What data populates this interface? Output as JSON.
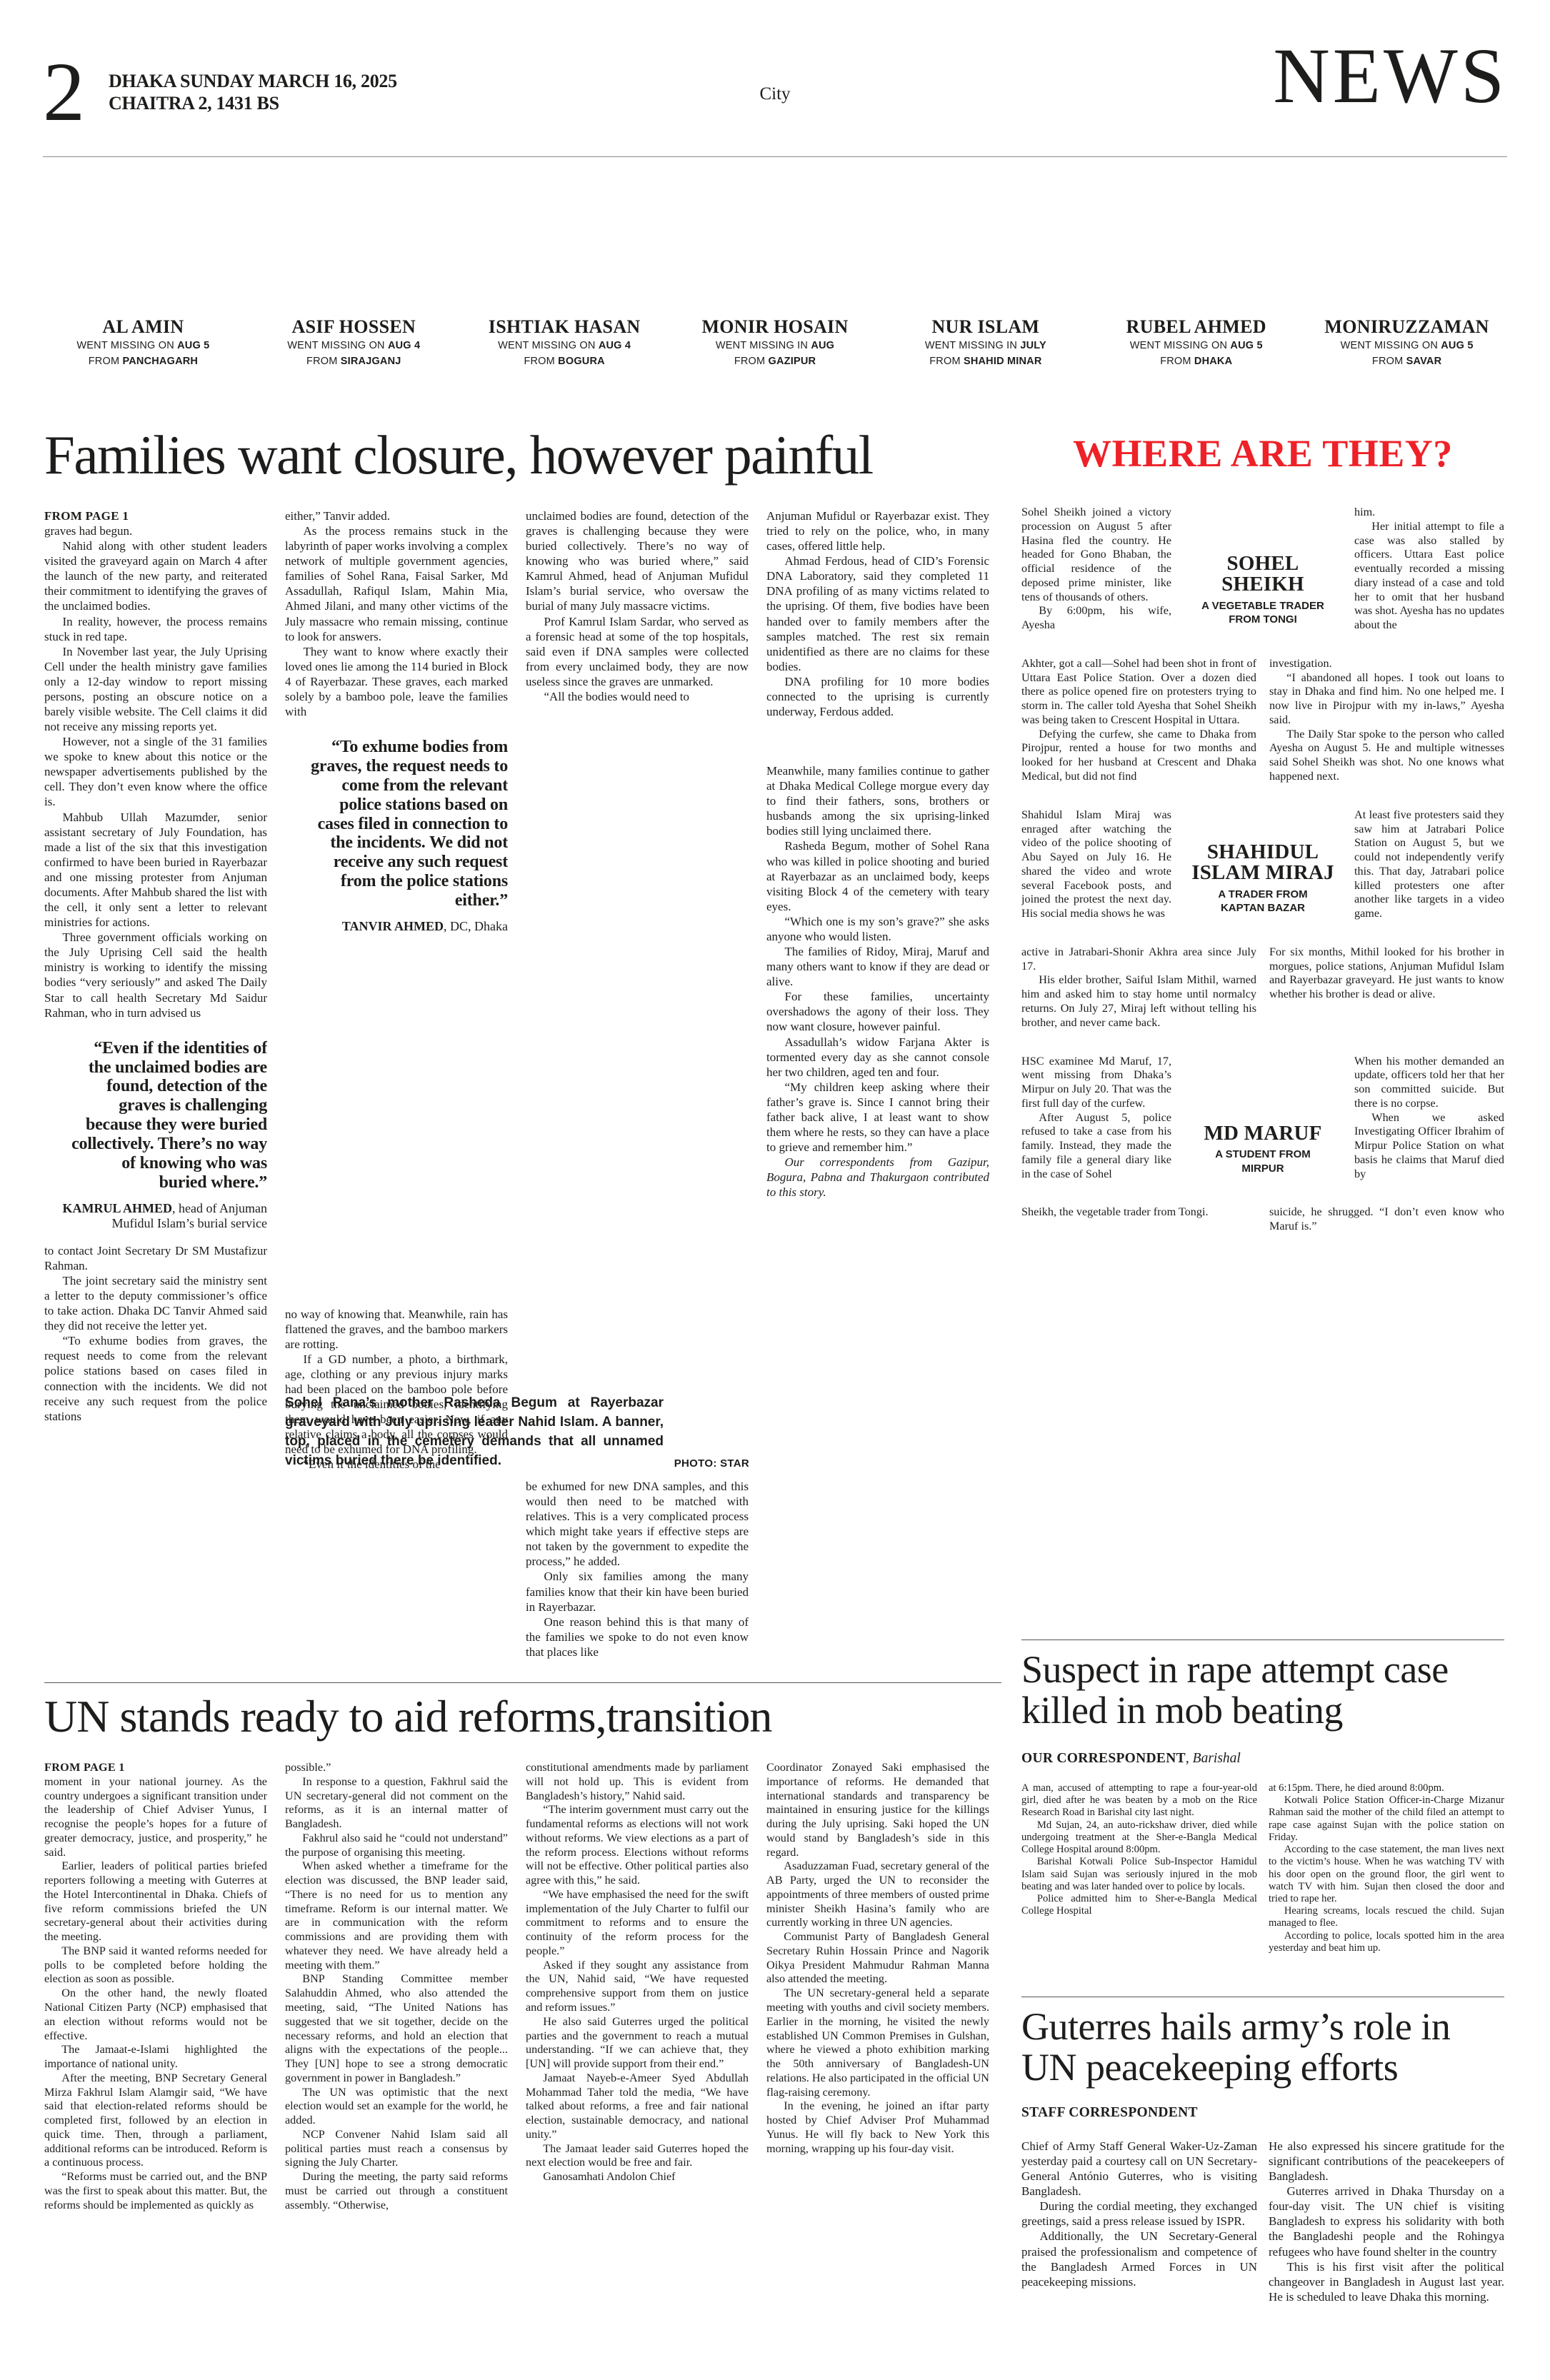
{
  "header": {
    "page_number": "2",
    "date": "DHAKA SUNDAY MARCH 16, 2025",
    "calendar": "CHAITRA 2, 1431 BS",
    "section": "City",
    "masthead": "NEWS"
  },
  "missing_strip": [
    {
      "name": "AL AMIN",
      "missing_prefix": "WENT MISSING ON ",
      "missing_date": "AUG 5",
      "from_prefix": "FROM ",
      "from_place": "PANCHAGARH"
    },
    {
      "name": "ASIF HOSSEN",
      "missing_prefix": "WENT MISSING ON ",
      "missing_date": "AUG 4",
      "from_prefix": "FROM ",
      "from_place": "SIRAJGANJ"
    },
    {
      "name": "ISHTIAK HASAN",
      "missing_prefix": "WENT MISSING ON ",
      "missing_date": "AUG 4",
      "from_prefix": "FROM ",
      "from_place": "BOGURA"
    },
    {
      "name": "MONIR HOSAIN",
      "missing_prefix": "WENT MISSING IN ",
      "missing_date": "AUG",
      "from_prefix": "FROM ",
      "from_place": "GAZIPUR"
    },
    {
      "name": "NUR ISLAM",
      "missing_prefix": "WENT MISSING IN ",
      "missing_date": "JULY",
      "from_prefix": "FROM ",
      "from_place": "SHAHID MINAR"
    },
    {
      "name": "RUBEL AHMED",
      "missing_prefix": "WENT MISSING ON ",
      "missing_date": "AUG 5",
      "from_prefix": "FROM ",
      "from_place": "DHAKA"
    },
    {
      "name": "MONIRUZZAMAN",
      "missing_prefix": "WENT MISSING ON ",
      "missing_date": "AUG 5",
      "from_prefix": "FROM ",
      "from_place": "SAVAR"
    }
  ],
  "families_article": {
    "headline": "Families want closure, however painful",
    "kicker": "FROM PAGE 1",
    "col1a": [
      "graves had begun.",
      "Nahid along with other student leaders visited the graveyard again on March 4 after the launch of the new party, and reiterated their commitment to identifying the graves of the unclaimed bodies.",
      "In reality, however, the process remains stuck in red tape.",
      "In November last year, the July Uprising Cell under the health ministry gave families only a 12-day window to report missing persons, posting an obscure notice on a barely visible website. The Cell claims it did not receive any missing reports yet.",
      "However, not a single of the 31 families we spoke to knew about this notice or the newspaper advertisements published by the cell. They don’t even know where the office is.",
      "Mahbub Ullah Mazumder, senior assistant secretary of July Foundation, has made a list of the six that this investigation confirmed to have been buried in Rayerbazar and one missing protester from Anjuman documents. After Mahbub shared the list with the cell, it only sent a letter to relevant ministries for actions.",
      "Three government officials working on the July Uprising Cell said the health ministry is working to identify the missing bodies “very seriously” and asked The Daily Star to call health Secretary Md Saidur Rahman, who in turn advised us"
    ],
    "pullquote1": {
      "text": "“Even if the identities of the unclaimed bodies are found, detection of the graves is challenging because they were buried collectively. There’s no way of knowing who was buried where.”",
      "name": "KAMRUL AHMED",
      "desc": ", head of Anjuman Mufidul Islam’s burial service"
    },
    "col1b": [
      "to contact Joint Secretary Dr SM Mustafizur Rahman.",
      "The joint secretary said the ministry sent a letter to the deputy commissioner’s office to take action. Dhaka DC Tanvir Ahmed said they did not receive the letter yet.",
      "“To exhume bodies from graves, the request needs to come from the relevant police stations based on cases filed in connection with the incidents. We did not receive any such request from the police stations"
    ],
    "col2a": [
      "either,” Tanvir added.",
      "As the process remains stuck in the labyrinth of paper works involving a complex network of multiple government agencies, families of Sohel Rana, Faisal Sarker, Md Assadullah, Rafiqul Islam, Mahin Mia, Ahmed Jilani, and many other victims of the July massacre who remain missing, continue to look for answers.",
      "They want to know where exactly their loved ones lie among the 114 buried in Block 4 of Rayerbazar. These graves, each marked solely by a bamboo pole, leave the families with"
    ],
    "pullquote2": {
      "text": "“To exhume bodies from graves, the request needs to come from the relevant police stations based on cases filed in connection to the incidents. We did not receive any such request from the police stations either.”",
      "name": "TANVIR AHMED",
      "desc": ", DC, Dhaka"
    },
    "col2b": [
      "no way of knowing that. Meanwhile, rain has flattened the graves, and the bamboo markers are rotting.",
      "If a GD number, a photo, a birthmark, age, clothing or any previous injury marks had been placed on the bamboo pole before burying the unclaimed bodies, identifying them would have been easier. Now, if any relative claims a body, all the corpses would need to be exhumed for DNA profiling.",
      "“Even if the identities of the"
    ],
    "col3a": [
      "unclaimed bodies are found, detection of the graves is challenging because they were buried collectively. There’s no way of knowing who was buried where,” said Kamrul Ahmed, head of Anjuman Mufidul Islam’s burial service, who oversaw the burial of many July massacre victims.",
      "Prof Kamrul Islam Sardar, who served as a forensic head at some of the top hospitals, said even if DNA samples were collected from every unclaimed body, they are now useless since the graves are unmarked.",
      "“All the bodies would need to"
    ],
    "col3b": [
      "be exhumed for new DNA samples, and this would then need to be matched with relatives. This is a very complicated process which might take years if effective steps are not taken by the government to expedite the process,” he added.",
      "Only six families among the many families know that their kin have been buried in Rayerbazar.",
      "One reason behind this is that many of the families we spoke to do not even know that places like"
    ],
    "col4a": [
      "Anjuman Mufidul or Rayerbazar exist. They tried to rely on the police, who, in many cases, offered little help.",
      "Ahmad Ferdous, head of CID’s Forensic DNA Laboratory, said they completed 11 DNA profiling of as many victims related to the uprising. Of them, five bodies have been handed over to family members after the samples matched. The rest six remain unidentified as there are no claims for these bodies.",
      "DNA profiling for 10 more bodies connected to the uprising is currently underway, Ferdous added."
    ],
    "col4b": [
      "Meanwhile, many families continue to gather at Dhaka Medical College morgue every day to find their fathers, sons, brothers or husbands among the six uprising-linked bodies still lying unclaimed there.",
      "Rasheda Begum, mother of Sohel Rana who was killed in police shooting and buried at Rayerbazar as an unclaimed body, keeps visiting Block 4 of the cemetery with teary eyes.",
      "“Which one is my son’s grave?” she asks anyone who would listen.",
      "The families of Ridoy, Miraj, Maruf and many others want to know if they are dead or alive.",
      "For these families, uncertainty overshadows the agony of their loss. They now want closure, however painful.",
      "Assadullah’s widow Farjana Akter is tormented every day as she cannot console her two children, aged ten and four.",
      "“My children keep asking where their father’s grave is. Since I cannot bring their father back alive, I at least want to show them where he rests, so they can have a place to grieve and remember him.”"
    ],
    "closer": "Our correspondents from Gazipur, Bogura, Pabna and Thakurgaon contributed to this story.",
    "caption": "Sohel Rana’s mother Rasheda Begum at Rayerbazar graveyard with July uprising leader Nahid Islam. A banner, top, placed in the cemetery demands that all unnamed victims buried there be identified.",
    "photo_credit": "PHOTO: STAR"
  },
  "where_panel": {
    "title": "WHERE ARE THEY?",
    "profiles": [
      {
        "name": "SOHEL SHEIKH",
        "role1": "A VEGETABLE TRADER",
        "role2": "FROM TONGI",
        "left": [
          "Sohel Sheikh joined a victory procession on August 5 after Hasina fled the country. He headed for Gono Bhaban, the official residence of the deposed prime minister, like tens of thousands of others.",
          "By 6:00pm, his wife, Ayesha"
        ],
        "right": [
          "him.",
          "Her initial attempt to file a case was also stalled by officers. Uttara East police eventually recorded a missing diary instead of a case and told her to omit that her husband was shot. Ayesha has no updates about the"
        ],
        "wide_left": [
          "Akhter, got a call—Sohel had been shot in front of Uttara East Police Station. Over a dozen died there as police opened fire on protesters trying to storm in. The caller told Ayesha that Sohel Sheikh was being taken to Crescent Hospital in Uttara.",
          "Defying the curfew, she came to Dhaka from Pirojpur, rented a house for two months and looked for her husband at Crescent and Dhaka Medical, but did not find"
        ],
        "wide_right": [
          "investigation.",
          "“I abandoned all hopes. I took out loans to stay in Dhaka and find him. No one helped me. I now live in Pirojpur with my in-laws,” Ayesha said.",
          "The Daily Star spoke to the person who called Ayesha on August 5. He and multiple witnesses said Sohel Sheikh was shot. No one knows what happened next."
        ]
      },
      {
        "name": "SHAHIDUL ISLAM MIRAJ",
        "role1": "A TRADER FROM",
        "role2": "KAPTAN BAZAR",
        "left": [
          "Shahidul Islam Miraj was enraged after watching the video of the police shooting of Abu Sayed on July 16. He shared the video and wrote several Facebook posts, and joined the protest the next day. His social media shows he was"
        ],
        "right": [
          "At least five protesters said they saw him at Jatrabari Police Station on August 5, but we could not independently verify this. That day, Jatrabari police killed protesters one after another like targets in a video game."
        ],
        "wide_left": [
          "active in Jatrabari-Shonir Akhra area since July 17.",
          "His elder brother, Saiful Islam Mithil, warned him and asked him to stay home until normalcy returns. On July 27, Miraj left without telling his brother, and never came back."
        ],
        "wide_right": [
          "For six months, Mithil looked for his brother in morgues, police stations, Anjuman Mufidul Islam and Rayerbazar graveyard. He just wants to know whether his brother is dead or alive."
        ]
      },
      {
        "name": "MD MARUF",
        "role1": "A STUDENT FROM",
        "role2": "MIRPUR",
        "left": [
          "HSC examinee Md Maruf, 17, went missing from Dhaka’s Mirpur on July 20. That was the first full day of the curfew.",
          "After August 5, police refused to take a case from his family. Instead, they made the family file a general diary like in the case of Sohel"
        ],
        "right": [
          "When his mother demanded an update, officers told her that her son committed suicide. But there is no corpse.",
          "When we asked Investigating Officer Ibrahim of Mirpur Police Station on what basis he claims that Maruf died by"
        ],
        "wide_left": [
          "Sheikh, the vegetable trader from Tongi."
        ],
        "wide_right": [
          "suicide, he shrugged. “I don’t even know who Maruf is.”"
        ]
      }
    ]
  },
  "un_article": {
    "headline": "UN stands ready to aid reforms,transition",
    "kicker": "FROM PAGE 1",
    "col1": [
      "moment in your national journey. As the country undergoes a significant transition under the leadership of Chief Adviser Yunus, I recognise the people’s hopes for a future of greater democracy, justice, and prosperity,” he said.",
      "Earlier, leaders of political parties briefed reporters following a meeting with Guterres at the Hotel Intercontinental in Dhaka. Chiefs of five reform commissions briefed the UN secretary-general about their activities during the meeting.",
      "The BNP said it wanted reforms needed for polls to be completed before holding the election as soon as possible.",
      "On the other hand, the newly floated National Citizen Party (NCP) emphasised that an election without reforms would not be effective.",
      "The Jamaat-e-Islami highlighted the importance of national unity.",
      "After the meeting, BNP Secretary General Mirza Fakhrul Islam Alamgir said, “We have said that election-related reforms should be completed first, followed by an election in quick time. Then, through a parliament, additional reforms can be introduced. Reform is a continuous process.",
      "“Reforms must be carried out, and the BNP was the first to speak about this matter. But, the reforms should be implemented as quickly as"
    ],
    "col2": [
      "possible.”",
      "In response to a question, Fakhrul said the UN secretary-general did not comment on the reforms, as it is an internal matter of Bangladesh.",
      "Fakhrul also said he “could not understand” the purpose of organising this meeting.",
      "When asked whether a timeframe for the election was discussed, the BNP leader said, “There is no need for us to mention any timeframe. Reform is our internal matter. We are in communication with the reform commissions and are providing them with whatever they need. We have already held a meeting with them.”",
      "BNP Standing Committee member Salahuddin Ahmed, who also attended the meeting, said, “The United Nations has suggested that we sit together, decide on the necessary reforms, and hold an election that aligns with the expectations of the people... They [UN] hope to see a strong democratic government in power in Bangladesh.”",
      "The UN was optimistic that the next election would set an example for the world, he added.",
      "NCP Convener Nahid Islam said all political parties must reach a consensus by signing the July Charter.",
      "During the meeting, the party said reforms must be carried out through a constituent assembly. “Otherwise,"
    ],
    "col3": [
      "constitutional amendments made by parliament will not hold up. This is evident from Bangladesh’s history,” Nahid said.",
      "“The interim government must carry out the fundamental reforms as elections will not work without reforms. We view elections as a part of the reform process. Elections without reforms will not be effective. Other political parties also agree with this,” he said.",
      "“We have emphasised the need for the swift implementation of the July Charter to fulfil our commitment to reforms and to ensure the continuity of the reform process for the people.”",
      "Asked if they sought any assistance from the UN, Nahid said, “We have requested comprehensive support from them on justice and reform issues.”",
      "He also said Guterres urged the political parties and the government to reach a mutual understanding. “If we can achieve that, they [UN] will provide support from their end.”",
      "Jamaat Nayeb-e-Ameer Syed Abdullah Mohammad Taher told the media, “We have talked about reforms, a free and fair national election, sustainable democracy, and national unity.”",
      "The Jamaat leader said Guterres hoped the next election would be free and fair.",
      "Ganosamhati Andolon Chief"
    ],
    "col4": [
      "Coordinator Zonayed Saki emphasised the importance of reforms. He demanded that international standards and transparency be maintained in ensuring justice for the killings during the July uprising. Saki hoped the UN would stand by Bangladesh’s side in this regard.",
      "Asaduzzaman Fuad, secretary general of the AB Party, urged the UN to reconsider the appointments of three members of ousted prime minister Sheikh Hasina’s family who are currently working in three UN agencies.",
      "Communist Party of Bangladesh General Secretary Ruhin Hossain Prince and Nagorik Oikya President Mahmudur Rahman Manna also attended the meeting.",
      "The UN secretary-general held a separate meeting with youths and civil society members. Earlier in the morning, he visited the newly established UN Common Premises in Gulshan, where he viewed a photo exhibition marking the 50th anniversary of Bangladesh-UN relations. He also participated in the official UN flag-raising ceremony.",
      "In the evening, he joined an iftar party hosted by Chief Adviser Prof Muhammad Yunus. He will fly back to New York this morning, wrapping up his four-day visit."
    ]
  },
  "rape_article": {
    "headline": "Suspect in rape attempt case killed in mob beating",
    "byline": "OUR CORRESPONDENT",
    "byline_loc": ", Barishal",
    "col1": [
      "A man, accused of attempting to rape a four-year-old girl, died after he was beaten by a mob on the Rice Research Road in Barishal city last night.",
      "Md Sujan, 24, an auto-rickshaw driver, died while undergoing treatment at the Sher-e-Bangla Medical College Hospital around 8:00pm.",
      "Barishal Kotwali Police Sub-Inspector Hamidul Islam said Sujan was seriously injured in the mob beating and was later handed over to police by locals.",
      "Police admitted him to Sher-e-Bangla Medical College Hospital"
    ],
    "col2": [
      "at 6:15pm. There, he died around 8:00pm.",
      "Kotwali Police Station Officer-in-Charge Mizanur Rahman said the mother of the child filed an attempt to rape case against Sujan with the police station on Friday.",
      "According to the case statement, the man lives next to the victim’s house. When he was watching TV with his door open on the ground floor, the girl went to watch TV with him. Sujan then closed the door and tried to rape her.",
      "Hearing screams, locals rescued the child. Sujan managed to flee.",
      "According to police, locals spotted him in the area yesterday and beat him up."
    ]
  },
  "guterres_article": {
    "headline": "Guterres hails army’s role in UN peacekeeping efforts",
    "byline": "STAFF CORRESPONDENT",
    "col1": [
      "Chief of Army Staff General Waker-Uz-Zaman yesterday paid a courtesy call on UN Secretary-General António Guterres, who is visiting Bangladesh.",
      "During the cordial meeting, they exchanged greetings, said a press release issued by ISPR.",
      "Additionally, the UN Secretary-General praised the professionalism and competence of the Bangladesh Armed Forces in UN peacekeeping missions."
    ],
    "col2": [
      "He also expressed his sincere gratitude for the significant contributions of the peacekeepers of Bangladesh.",
      "Guterres arrived in Dhaka Thursday on a four-day visit. The UN chief is visiting Bangladesh to express his solidarity with both the Bangladeshi people and the Rohingya refugees who have found shelter in the country",
      "This is his first visit after the political changeover in Bangladesh in August last year. He is scheduled to leave Dhaka this morning."
    ]
  }
}
